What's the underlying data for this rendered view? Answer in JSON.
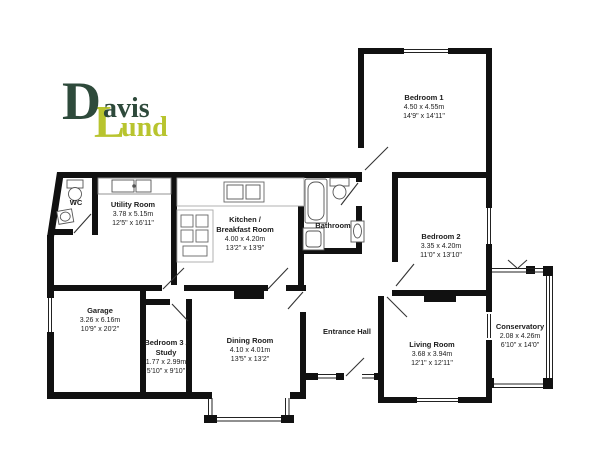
{
  "logo": {
    "word1_initial": "D",
    "word1_rest": "avis",
    "word2_initial": "L",
    "word2_rest": "und",
    "color_dark": "#2e4a3b",
    "color_green": "#b8c42e"
  },
  "colors": {
    "wall": "#111111",
    "background": "#ffffff",
    "fixture_outline": "#555555"
  },
  "rooms": [
    {
      "name": "Bedroom 1",
      "metric": "4.50 x 4.55m",
      "imperial": "14'9\" x 14'11\""
    },
    {
      "name": "Bedroom 2",
      "metric": "3.35 x 4.20m",
      "imperial": "11'0\" x 13'10\""
    },
    {
      "name": "Utility Room",
      "metric": "3.78 x 5.15m",
      "imperial": "12'5\" x 16'11\""
    },
    {
      "name": "WC"
    },
    {
      "name": "Kitchen /",
      "name2": "Breakfast Room",
      "metric": "4.00 x 4.20m",
      "imperial": "13'2\" x 13'9\""
    },
    {
      "name": "Bathroom"
    },
    {
      "name": "Garage",
      "metric": "3.26 x 6.16m",
      "imperial": "10'9\" x 20'2\""
    },
    {
      "name": "Bedroom 3 /",
      "name2": "Study",
      "metric": "1.77 x 2.99m",
      "imperial": "5'10\" x 9'10\""
    },
    {
      "name": "Dining Room",
      "metric": "4.10 x 4.01m",
      "imperial": "13'5\" x 13'2\""
    },
    {
      "name": "Entrance Hall"
    },
    {
      "name": "Living Room",
      "metric": "3.68 x 3.94m",
      "imperial": "12'1\" x 12'11\""
    },
    {
      "name": "Conservatory",
      "metric": "2.08 x 4.26m",
      "imperial": "6'10\" x 14'0\""
    }
  ]
}
